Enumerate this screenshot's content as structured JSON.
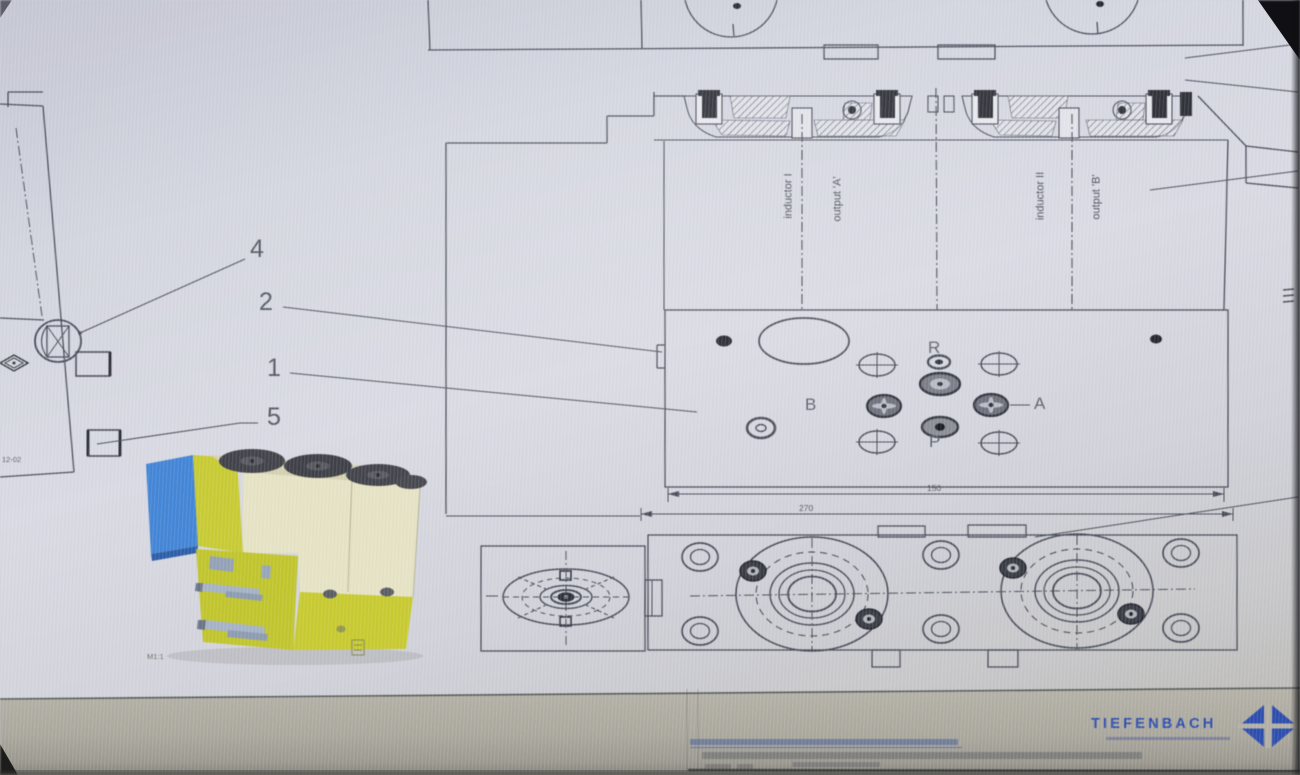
{
  "drawing": {
    "callouts": [
      {
        "label": "4"
      },
      {
        "label": "2"
      },
      {
        "label": "1"
      },
      {
        "label": "5"
      }
    ],
    "port_face": {
      "top_port": "R",
      "left_port": "B",
      "right_port": "A",
      "bottom_port": "P"
    },
    "section_labels": {
      "inductor_1": "inductor I",
      "output_a": "output 'A'",
      "inductor_2": "inductor II",
      "output_b": "output 'B'"
    },
    "dimensions": {
      "inner_width": "150",
      "outer_width": "270"
    },
    "side_view_code": "12-02",
    "scale_note": "M1:1"
  },
  "title_block": {
    "brand": "TIEFENBACH"
  },
  "colors": {
    "brand_blue": "#2a4cae",
    "line": "#474b58",
    "valve_yellow": "#c7cb2e",
    "valve_cream": "#e8e5c6",
    "plate_blue": "#4285d8",
    "coil_dark": "#404048",
    "paper": "#d7d9e3"
  }
}
